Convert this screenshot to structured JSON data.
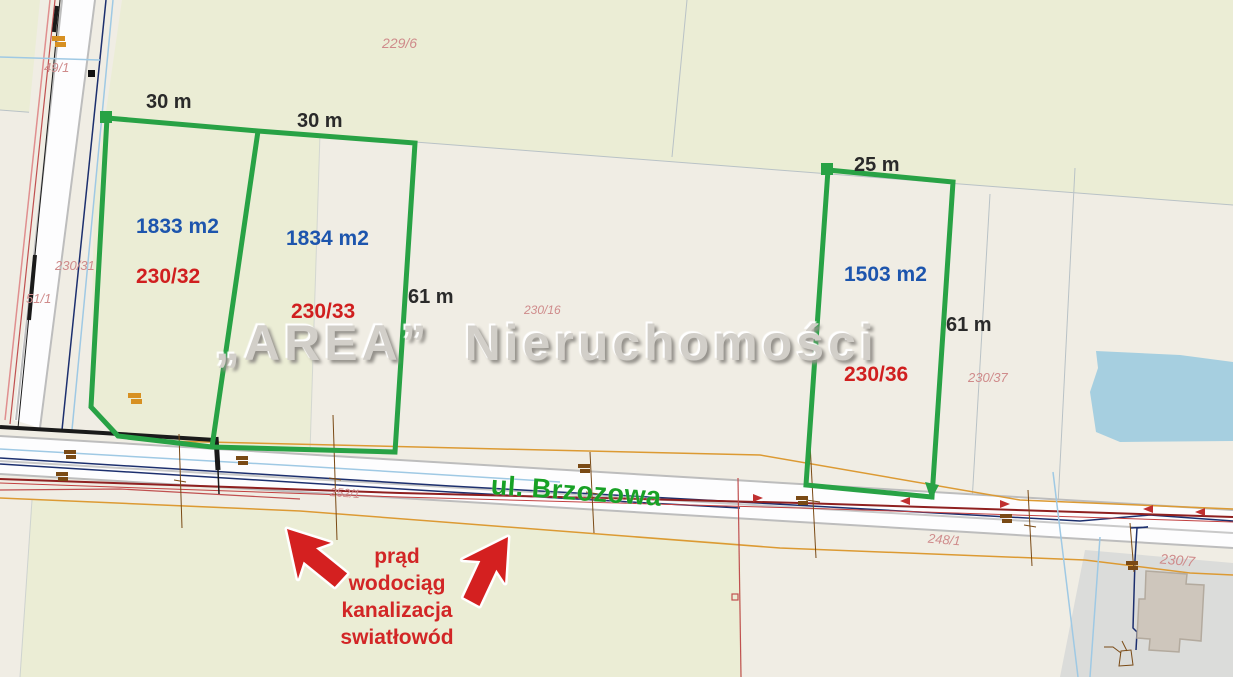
{
  "watermark": "„AREA” Nieruchomości",
  "street": {
    "name": "ul. Brzozowa"
  },
  "plots": [
    {
      "number": "230/32",
      "area": "1833 m2",
      "frontage": "30 m"
    },
    {
      "number": "230/33",
      "area": "1834 m2",
      "frontage": "30 m",
      "depth": "61 m"
    },
    {
      "number": "230/36",
      "area": "1503 m2",
      "frontage": "25 m",
      "depth": "61 m"
    }
  ],
  "utilities_note": {
    "lines": [
      "prąd",
      "wodociąg",
      "kanalizacja",
      "swiatłowód"
    ]
  },
  "cadastral_labels": [
    "229/6",
    "49/1",
    "230/31",
    "51/1",
    "230/16",
    "252/1",
    "230/37",
    "248/1",
    "230/7"
  ],
  "colors": {
    "field_green": "#ebedd5",
    "parcel_beige": "#f0ede4",
    "road_white": "#fdfdfe",
    "gray_parcel": "#dbdcda",
    "water_blue": "#a6cfe0",
    "building_fill": "#cec6bc",
    "building_edge": "#b3aa9e",
    "boundary_gray": "#b9c2c6",
    "plot_outline": "#28a245",
    "area_blue": "#1d55ad",
    "plot_red": "#d01f1f",
    "cad_red": "#cf8b8b",
    "street_green": "#18a125",
    "note_red": "#d22626",
    "watermark_gray": "#d2cfc9",
    "orange_line": "#dc9a33",
    "orange_mark": "#d79022",
    "maroon_line": "#8f2020",
    "navy_line": "#1c2f6e",
    "cyan_line": "#9fc9e4",
    "brown_mark": "#7a4a15",
    "black_line": "#1a1a1a",
    "arrow_red": "#d42020"
  }
}
